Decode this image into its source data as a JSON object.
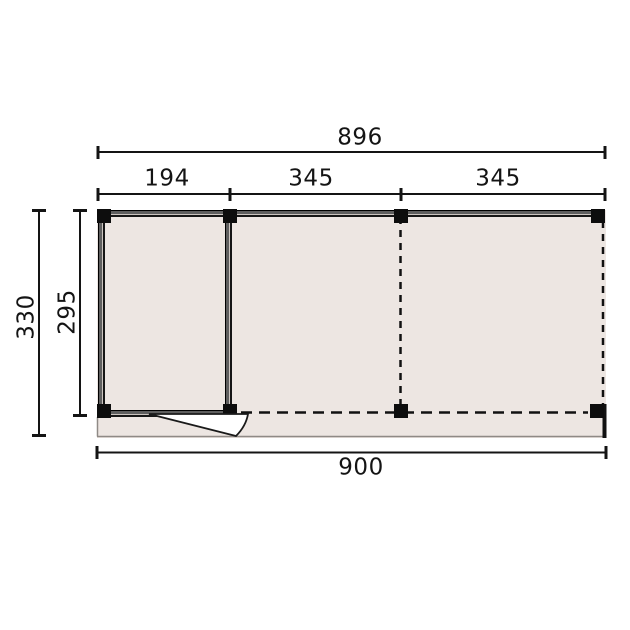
{
  "diagram": {
    "type": "floor-plan",
    "description": "Top-view construction drawing of a flat-roof garden building: one enclosed room with a single outward-swinging door on the left, two open canopy bays marked with dashed lines, a front deck strip, and 8 square posts.",
    "dimensions": {
      "top_total": "896",
      "top_segments": [
        "194",
        "345",
        "345"
      ],
      "side_outer": "330",
      "side_inner": "295",
      "bottom_total": "900"
    },
    "elements": {
      "post_count": 8,
      "door": "outward swing door at bottom of enclosed room",
      "dashed_edges": "open-bay division and open front/right edges"
    },
    "colors": {
      "background": "#ffffff",
      "floor_fill": "#ede6e2",
      "wall_core": "#5f5f5f",
      "line": "#141414",
      "deck_edge": "#8f8a86"
    }
  }
}
